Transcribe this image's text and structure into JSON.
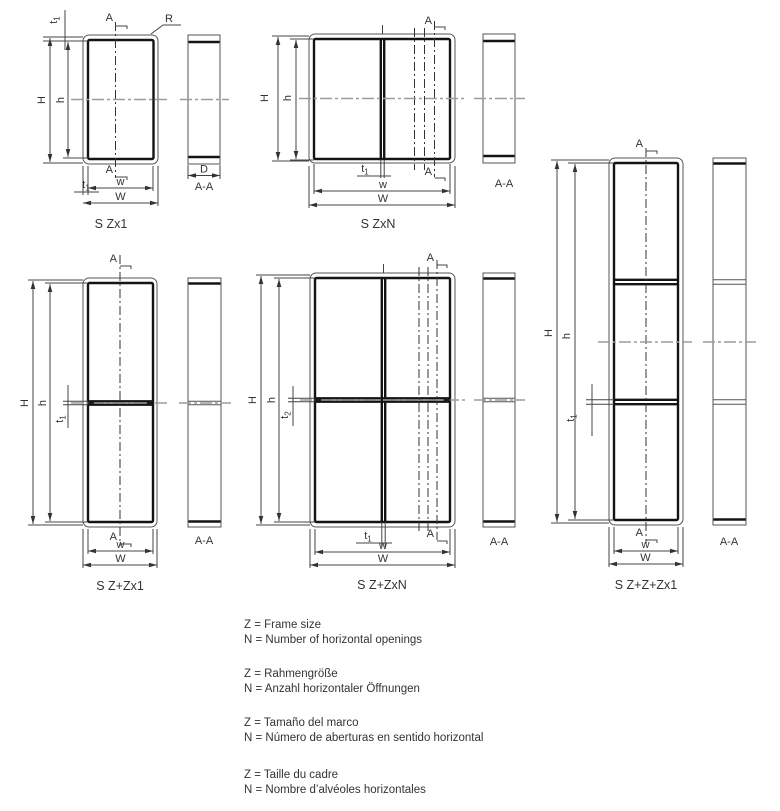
{
  "titles": {
    "d1": "S Zx1",
    "d2": "S ZxN",
    "d3": "S Z+Zx1",
    "d4": "S Z+ZxN",
    "d5": "S Z+Z+Zx1"
  },
  "symbols": {
    "section": "A",
    "section_view": "A-A",
    "radius": "R",
    "overall_height": "H",
    "inner_height": "h",
    "inner_width": "w",
    "overall_width": "W",
    "depth": "D",
    "thickness_t": "t",
    "thickness_sub1": "1",
    "thickness_sub2": "2"
  },
  "legend": [
    {
      "z": "Z = Frame size",
      "n": "N = Number of horizontal openings"
    },
    {
      "z": "Z = Rahmengröße",
      "n": "N = Anzahl horizontaler Öffnungen"
    },
    {
      "z": "Z = Tamaño del marco",
      "n": "N = Número de aberturas en sentido horizontal"
    },
    {
      "z": "Z = Taille du cadre",
      "n": "N = Nombre d’alvéoles horizontales"
    }
  ],
  "colors": {
    "frame_line": "#141414",
    "thin_line": "#555555",
    "centerline": "#9c9c9c",
    "text": "#333333"
  }
}
